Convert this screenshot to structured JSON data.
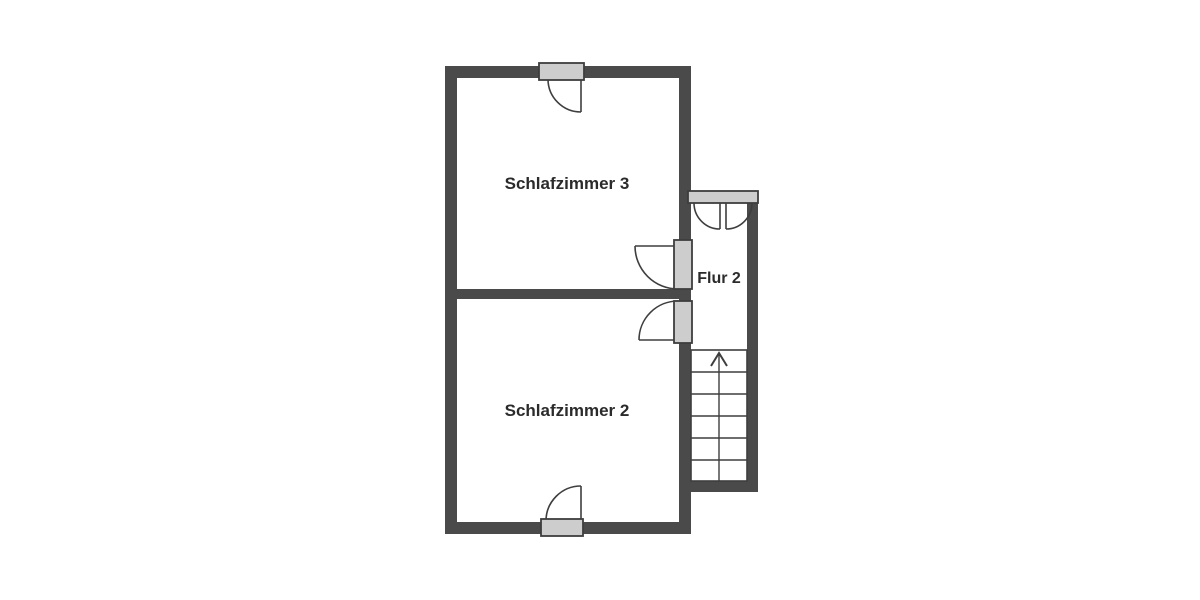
{
  "plan": {
    "type": "floor-plan",
    "rooms": [
      {
        "id": "schlafzimmer-3",
        "label": "Schlafzimmer 3"
      },
      {
        "id": "schlafzimmer-2",
        "label": "Schlafzimmer 2"
      },
      {
        "id": "flur-2",
        "label": "Flur 2"
      }
    ],
    "stairs": {
      "direction": "up",
      "treads": 6
    }
  },
  "colors": {
    "wall": "#4a4a4a",
    "door_fill": "#cdcdcd",
    "line": "#3e3e3e",
    "text": "#2b2b2b",
    "background": "#ffffff"
  }
}
